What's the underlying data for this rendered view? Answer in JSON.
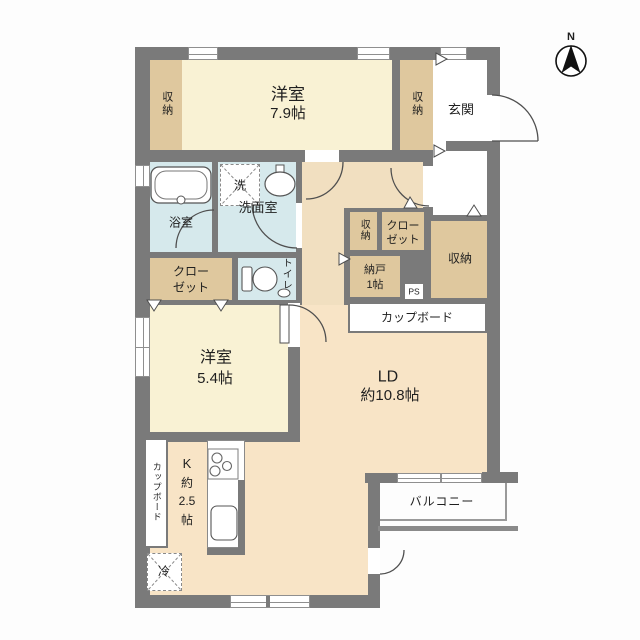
{
  "compass": {
    "north_label": "N"
  },
  "rooms": {
    "bedroom1": {
      "name": "洋室",
      "size": "7.9帖"
    },
    "bedroom2": {
      "name": "洋室",
      "size": "5.4帖"
    },
    "living_dining": {
      "name": "LD",
      "size": "約10.8帖"
    },
    "kitchen": {
      "l1": "K",
      "l2": "約",
      "l3": "2.5",
      "l4": "帖"
    },
    "entrance": {
      "name": "玄関"
    },
    "bathroom": {
      "name": "浴室"
    },
    "washroom": {
      "name": "洗面室"
    },
    "toilet": {
      "name": "トイレ"
    },
    "storage_top_left": {
      "name": "収納"
    },
    "storage_top_right": {
      "name": "収納"
    },
    "storage_mid": {
      "name": "収納"
    },
    "storage_right": {
      "name": "収納"
    },
    "closet_left": {
      "line1": "クロー",
      "line2": "ゼット"
    },
    "closet_mid": {
      "line1": "クロー",
      "line2": "ゼット"
    },
    "nando": {
      "name": "納戸",
      "size": "1帖"
    },
    "balcony": {
      "name": "バルコニー"
    },
    "pipe_space": {
      "name": "PS"
    }
  },
  "fixtures": {
    "washing_machine": "洗",
    "refrigerator": "冷",
    "cupboard_top": "カップボード",
    "cupboard_left": "カップボード"
  },
  "icons": {
    "compass": "north-arrow-icon",
    "bathtub": "bathtub-icon",
    "basin": "washbasin-icon",
    "toilet": "toilet-icon",
    "stove": "stove-burners-icon",
    "kitchen_sink": "kitchen-sink-icon"
  },
  "colors": {
    "wall": "#7a7a7a",
    "bedroom": "#f9f2d4",
    "storage": "#dfc89e",
    "wet_area": "#d6e9ec",
    "living": "#f8e4c6",
    "hallway": "#f1dfc0",
    "outline": "#4f4f4f"
  }
}
